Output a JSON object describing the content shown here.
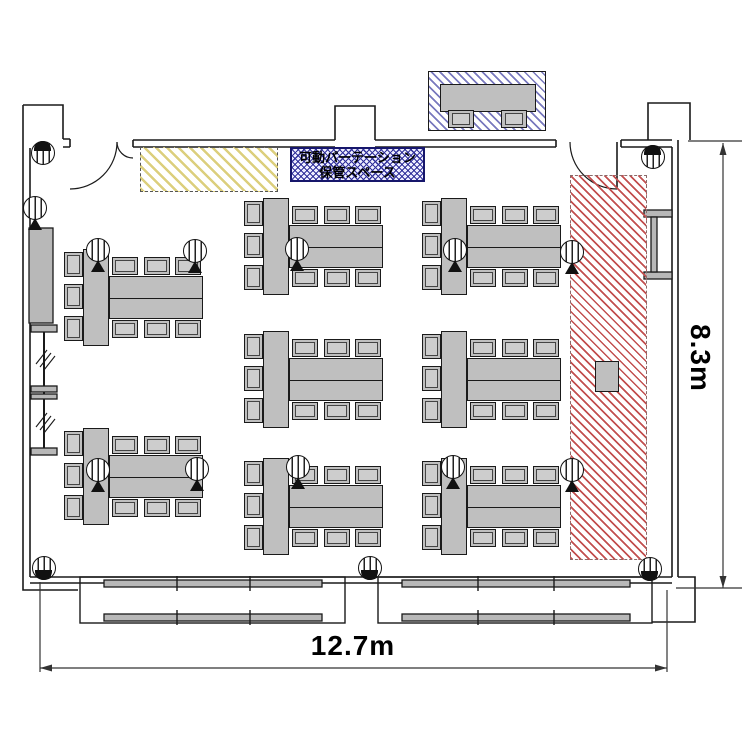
{
  "labels": {
    "storage_line1": "可動パーテーション",
    "storage_line2": "保管スペース",
    "width_dimension": "12.7m",
    "height_dimension": "8.3m"
  },
  "colors": {
    "furniture_fill": "#bfbfbf",
    "yellow_hatch": "#dccf7d",
    "navy_hatch": "#31319b",
    "red_hatch": "#c24f4f",
    "label_border": "#16166b",
    "outline": "#1a1a1a"
  },
  "floor_plan": {
    "counts": {
      "table_islands": 8,
      "chairs_per_island": 9,
      "reception_chairs": 2
    },
    "zones": [
      {
        "name": "yellow-highlight-area",
        "pattern": "diagonal-yellow"
      },
      {
        "name": "partition-storage-label",
        "pattern": "crosshatch-navy"
      },
      {
        "name": "reception-area",
        "pattern": "diagonal-navy"
      },
      {
        "name": "red-reserved-area",
        "pattern": "diagonal-red"
      }
    ],
    "table_groups": [
      {
        "x": 63,
        "y": 249
      },
      {
        "x": 63,
        "y": 428
      },
      {
        "x": 243,
        "y": 198
      },
      {
        "x": 243,
        "y": 331
      },
      {
        "x": 243,
        "y": 458
      },
      {
        "x": 421,
        "y": 198
      },
      {
        "x": 421,
        "y": 331
      },
      {
        "x": 421,
        "y": 458
      }
    ],
    "fixtures": [
      {
        "x": 43,
        "y": 153,
        "style": "cap-top"
      },
      {
        "x": 653,
        "y": 157,
        "style": "cap-top"
      },
      {
        "x": 44,
        "y": 568,
        "style": "cap-bottom"
      },
      {
        "x": 370,
        "y": 568,
        "style": "cap-bottom"
      },
      {
        "x": 650,
        "y": 569,
        "style": "cap-bottom"
      },
      {
        "x": 35,
        "y": 208,
        "style": "stand"
      },
      {
        "x": 98,
        "y": 250,
        "style": "stand"
      },
      {
        "x": 195,
        "y": 251,
        "style": "stand"
      },
      {
        "x": 297,
        "y": 249,
        "style": "stand"
      },
      {
        "x": 455,
        "y": 250,
        "style": "stand"
      },
      {
        "x": 572,
        "y": 252,
        "style": "stand"
      },
      {
        "x": 98,
        "y": 470,
        "style": "stand"
      },
      {
        "x": 197,
        "y": 469,
        "style": "stand"
      },
      {
        "x": 298,
        "y": 467,
        "style": "stand"
      },
      {
        "x": 453,
        "y": 467,
        "style": "stand"
      },
      {
        "x": 572,
        "y": 470,
        "style": "stand"
      }
    ]
  }
}
